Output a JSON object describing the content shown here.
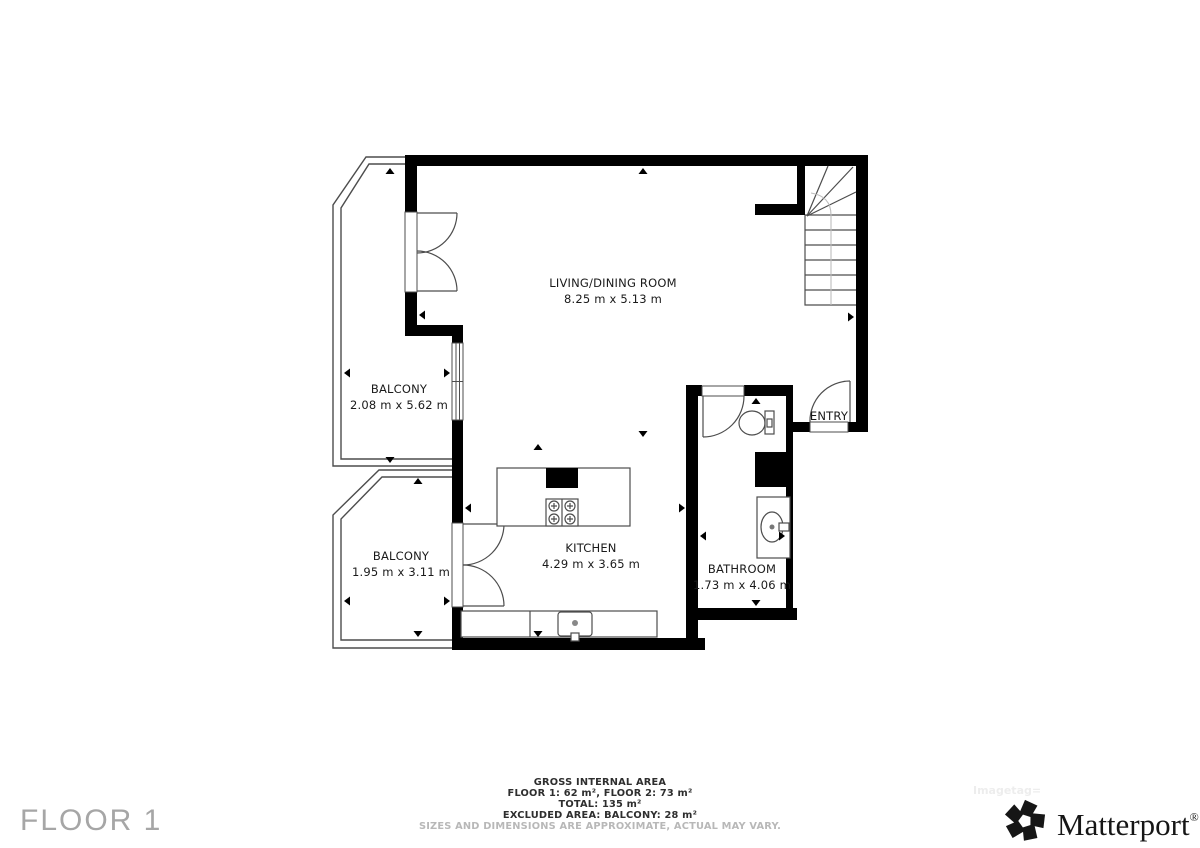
{
  "plan": {
    "rooms": {
      "living": {
        "name": "LIVING/DINING ROOM",
        "dims": "8.25 m x 5.13 m"
      },
      "balcony_upper": {
        "name": "BALCONY",
        "dims": "2.08 m x 5.62 m"
      },
      "balcony_lower": {
        "name": "BALCONY",
        "dims": "1.95 m x 3.11 m"
      },
      "kitchen": {
        "name": "KITCHEN",
        "dims": "4.29 m x 3.65 m"
      },
      "bathroom": {
        "name": "BATHROOM",
        "dims": "1.73 m x 4.06 m"
      },
      "entry": {
        "name": "ENTRY"
      }
    },
    "fixtures": [
      "staircase",
      "toilet",
      "bathroom-sink",
      "kitchen-island",
      "cooktop",
      "kitchen-counter",
      "kitchen-sink"
    ]
  },
  "footer": {
    "line1": "GROSS INTERNAL AREA",
    "line2": "FLOOR 1: 62 m², FLOOR 2: 73 m²",
    "line3": "TOTAL: 135 m²",
    "line4": "EXCLUDED AREA: BALCONY: 28 m²",
    "disclaimer": "SIZES AND DIMENSIONS ARE APPROXIMATE, ACTUAL MAY VARY."
  },
  "floor_label": "FLOOR 1",
  "watermark": "Imagetag=",
  "brand": {
    "name": "Matterport",
    "mark": "®"
  },
  "colors": {
    "wall": "#000000",
    "thin_line": "#4d4d4d",
    "light_line": "#bdbdbd",
    "label": "#1a1a1a",
    "footer_text": "#2e2e2e",
    "disclaimer": "#b8b8b8",
    "floor_label": "#a6a6a6",
    "brand": "#161616",
    "watermark": "#ededed"
  }
}
